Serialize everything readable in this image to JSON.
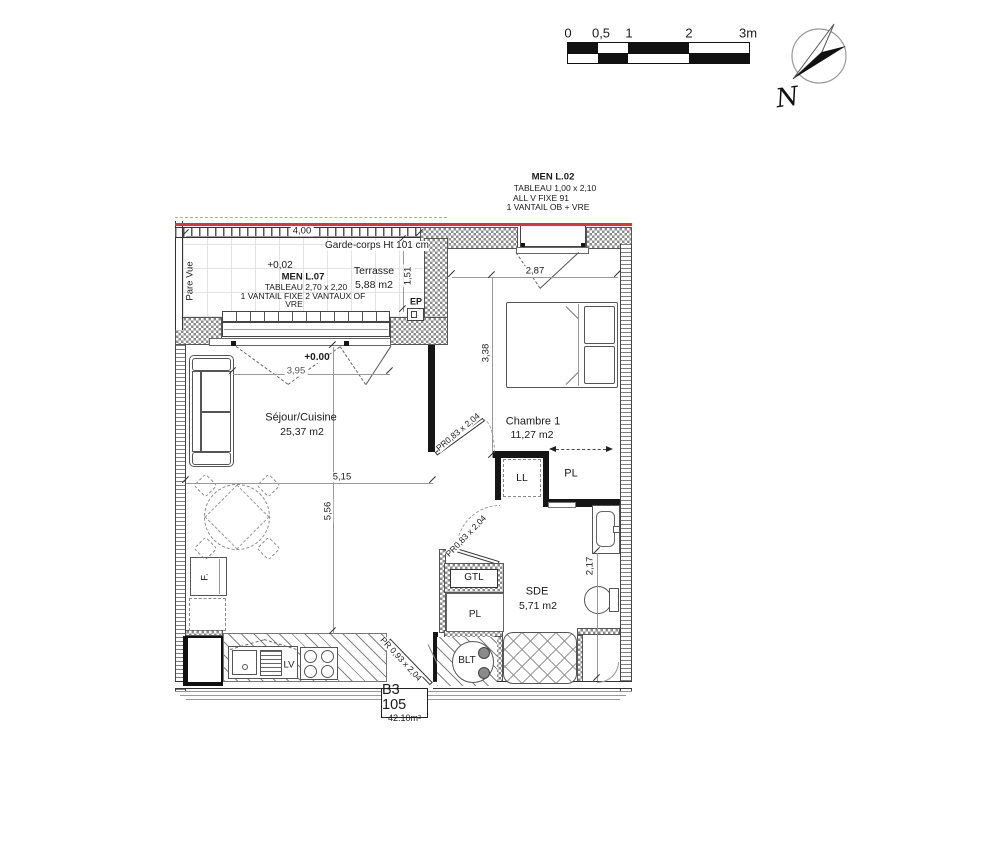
{
  "scale": {
    "t0": "0",
    "t05": "0,5",
    "t1": "1",
    "t2": "2",
    "t3": "3m"
  },
  "compass": {
    "n": "N"
  },
  "men_l02": {
    "title": "MEN L.02",
    "l1": "TABLEAU  1,00 x 2,10",
    "l2": "ALL V FIXE  91",
    "l3": "1 VANTAIL  OB + VRE"
  },
  "men_l07": {
    "level": "+0,02",
    "title": "MEN L.07",
    "l1": "TABLEAU  2,70 x 2,20",
    "l2": "1 VANTAIL FIXE  2 VANTAUX OF",
    "l3": "VRE"
  },
  "rooms": {
    "terrace": {
      "name": "Terrasse",
      "area": "5,88 m2"
    },
    "living": {
      "name": "Séjour/Cuisine",
      "area": "25,37 m2",
      "level": "+0.00"
    },
    "bedroom": {
      "name": "Chambre 1",
      "area": "11,27 m2"
    },
    "bath": {
      "name": "SDE",
      "area": "5,71 m2"
    }
  },
  "annotations": {
    "garde_corps": "Garde-corps Ht 101 cm",
    "pare_vue": "Pare Vue",
    "ep": "EP",
    "ll": "LL",
    "pl": "PL",
    "pl2": "PL",
    "gtl": "GTL",
    "blt": "BLT",
    "lv": "LV",
    "fridge": "F."
  },
  "doors": {
    "bedroom": "PR0,83 x 2,04",
    "bath": "PR0,83 x 2,04",
    "entry": "PR  0,93 x 2,04"
  },
  "dims": {
    "d400": "4,00",
    "d151": "1,51",
    "d287": "2,87",
    "d338": "3,38",
    "d395": "3,95",
    "d515": "5,15",
    "d556": "5,56",
    "d217": "2,17"
  },
  "unit": {
    "id": "B3 105",
    "area": "42.10m²"
  },
  "colors": {
    "red": "#e8302e"
  }
}
